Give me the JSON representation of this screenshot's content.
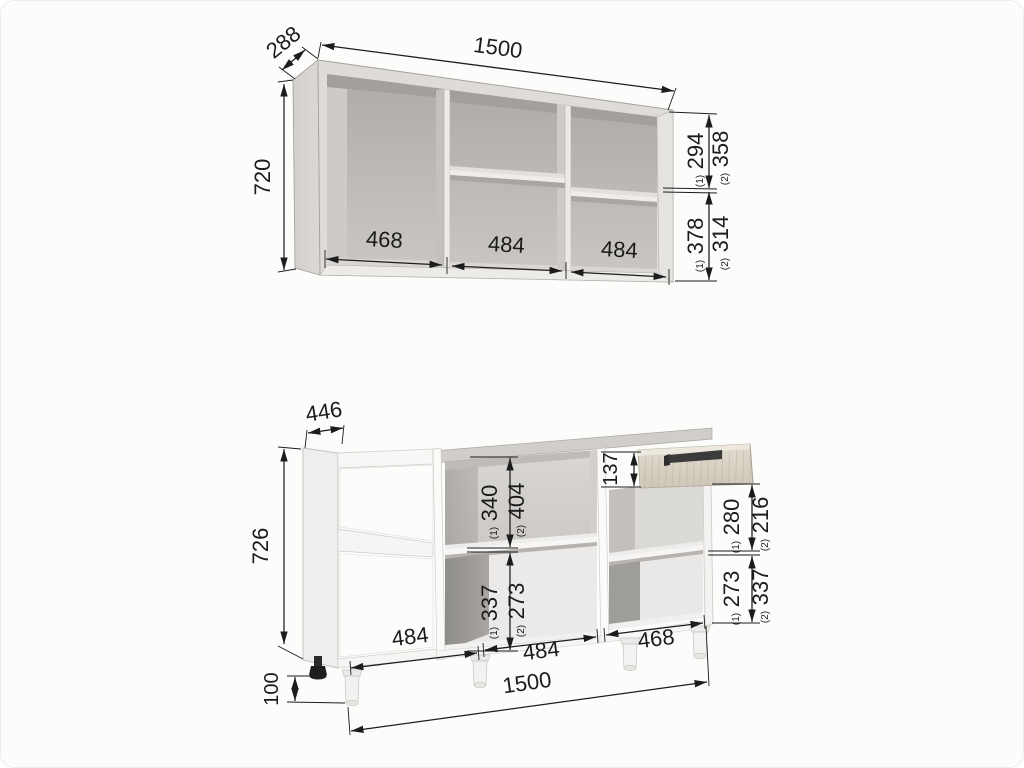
{
  "page": {
    "title": "Kitchen cabinet set dimensional drawing",
    "background": "#fcfcfb"
  },
  "colors": {
    "dimension_lines": "#1c1c1c",
    "carcass_light_gray": "#dedbd8",
    "carcass_white": "#f6f5f3",
    "interior_shadow": "#a29f9c",
    "drawer_wood": "#d9d3c5",
    "handle_dark": "#3b3b3b"
  },
  "wall_cabinet": {
    "label": "wall cabinet",
    "dims": {
      "width": "1500",
      "depth": "288",
      "height": "720",
      "compartments": [
        "468",
        "484",
        "484"
      ],
      "right_top": [
        {
          "sup": "(1)",
          "value": "294"
        },
        {
          "sup": "(2)",
          "value": "358"
        }
      ],
      "right_bottom": [
        {
          "sup": "(1)",
          "value": "378"
        },
        {
          "sup": "(2)",
          "value": "314"
        }
      ]
    }
  },
  "base_cabinet": {
    "label": "base cabinet",
    "dims": {
      "width": "1500",
      "depth": "446",
      "height": "726",
      "leg_height": "100",
      "drawer_height": "137",
      "compartments": [
        "484",
        "484",
        "468"
      ],
      "middle_top": [
        {
          "sup": "(1)",
          "value": "340"
        },
        {
          "sup": "(2)",
          "value": "404"
        }
      ],
      "middle_bottom": [
        {
          "sup": "(1)",
          "value": "337"
        },
        {
          "sup": "(2)",
          "value": "273"
        }
      ],
      "right_top": [
        {
          "sup": "(1)",
          "value": "280"
        },
        {
          "sup": "(2)",
          "value": "216"
        }
      ],
      "right_bottom": [
        {
          "sup": "(1)",
          "value": "273"
        },
        {
          "sup": "(2)",
          "value": "337"
        }
      ]
    }
  }
}
